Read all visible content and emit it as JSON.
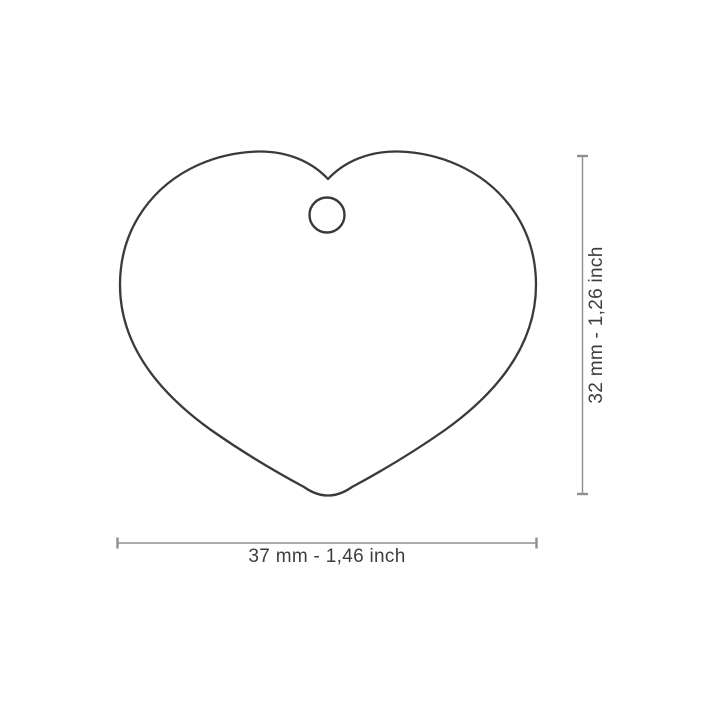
{
  "diagram": {
    "shape": "heart",
    "width_dimension": {
      "label": "37 mm - 1,46 inch",
      "mm": "37",
      "inch": "1,46"
    },
    "height_dimension": {
      "label": "32 mm - 1,26 inch",
      "mm": "32",
      "inch": "1,26"
    },
    "colors": {
      "background": "#ffffff",
      "outline": "#3a3a3a",
      "dimension_line": "#8f8f8f",
      "label_text": "#3d3d3d"
    }
  }
}
